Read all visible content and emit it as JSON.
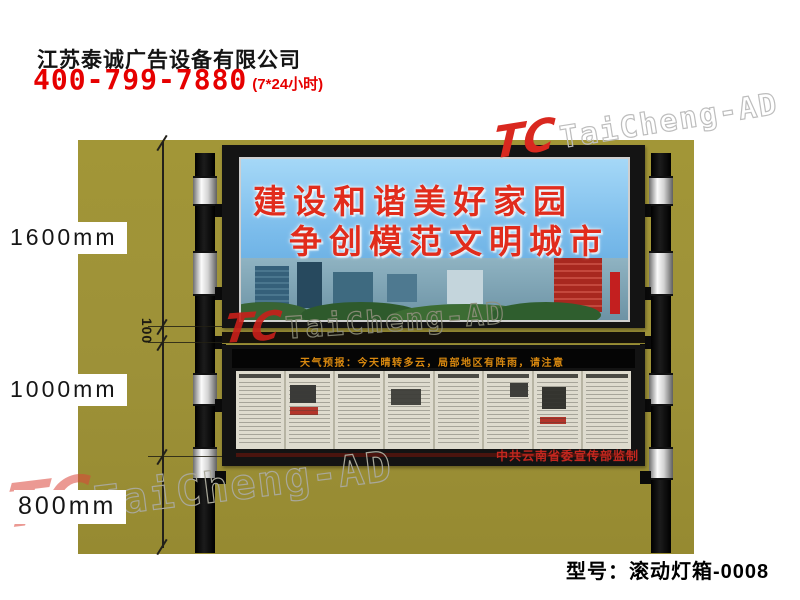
{
  "header": {
    "company_name": "江苏泰诚广告设备有限公司",
    "phone": "400-799-7880",
    "hours_note": "(7*24小时)"
  },
  "watermark": {
    "logo_text": "TC",
    "brand_text": "TaiCheng-AD"
  },
  "annotations": {
    "billboard_height": "1600mm",
    "gap": "100",
    "lower_box_height": "1000mm",
    "pole_height": "800mm"
  },
  "billboard": {
    "slogan_line1": "建设和谐美好家园",
    "slogan_line2": "争创模范文明城市"
  },
  "lower_box": {
    "led_ticker": "天气预报：今天晴转多云，局部地区有阵雨，请注意",
    "supervisor_credit": "中共云南省委宣传部监制"
  },
  "footer": {
    "model_label": "型号：滚动灯箱-0008"
  },
  "colors": {
    "accent_red": "#e60000",
    "photo_background": "#9d9138",
    "slogan_red": "#e12c1c",
    "led_text": "#d8880f"
  }
}
